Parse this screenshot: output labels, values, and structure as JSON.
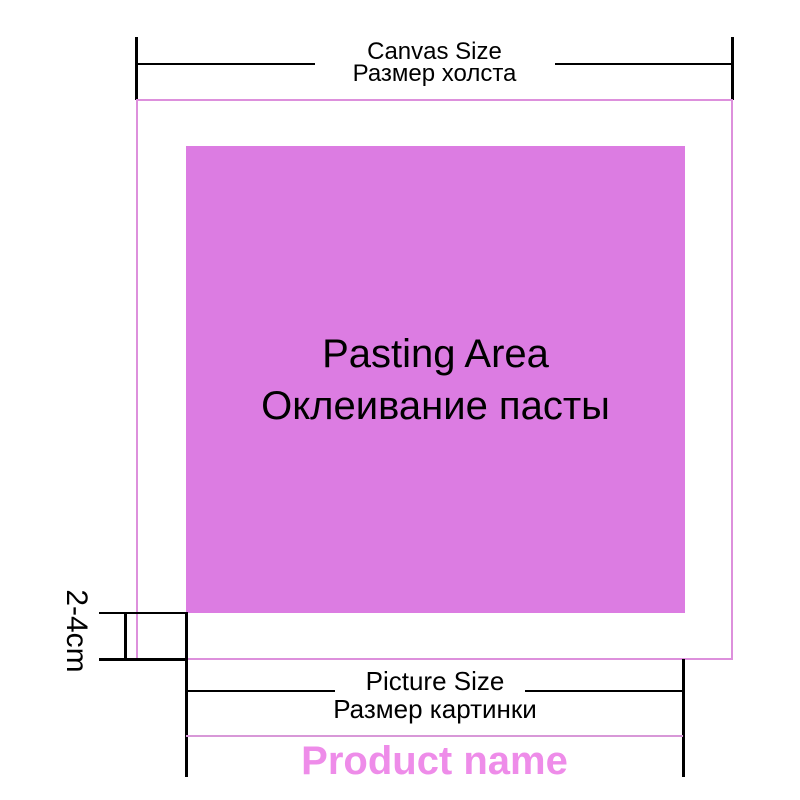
{
  "colors": {
    "pasting_fill": "#dc7ce2",
    "canvas_border": "#dd90dc",
    "divider": "#d898d8",
    "product_name": "#ee8ce9",
    "line": "#000000",
    "text": "#000000",
    "bg": "#ffffff"
  },
  "canvas_size": {
    "label_en": "Canvas Size",
    "label_ru": "Размер холста"
  },
  "pasting_area": {
    "label_en": "Pasting Area",
    "label_ru": "Оклеивание пасты"
  },
  "margin_gap": {
    "label": "2-4cm"
  },
  "picture_size": {
    "label_en": "Picture Size",
    "label_ru": "Размер картинки"
  },
  "product": {
    "label": "Product name"
  }
}
